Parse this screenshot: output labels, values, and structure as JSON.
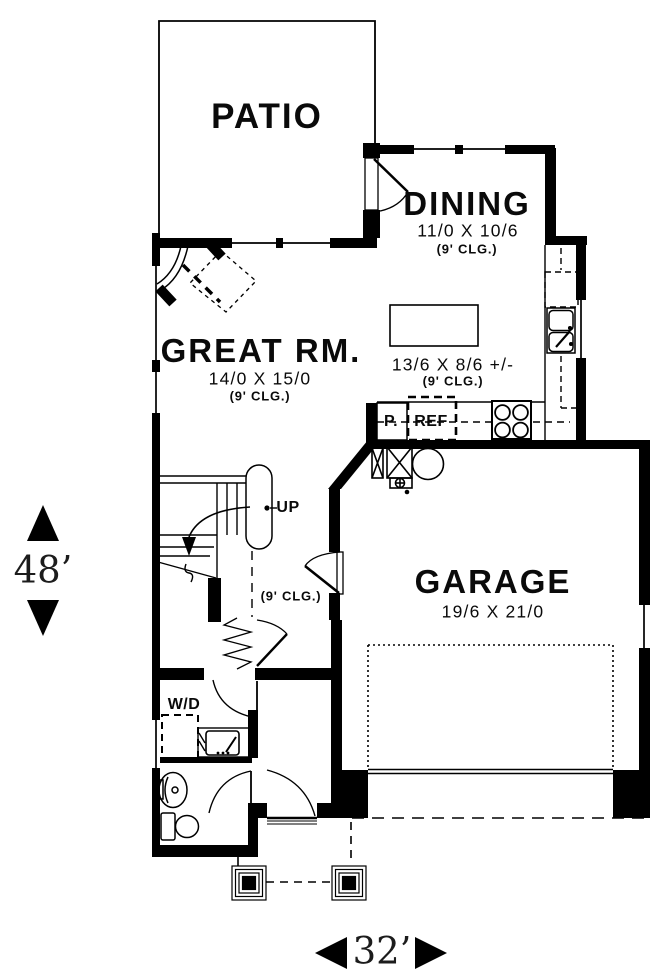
{
  "plan": {
    "patio": {
      "label": "PATIO"
    },
    "dining": {
      "label": "DINING",
      "dims": "11/0 X 10/6",
      "clg": "(9' CLG.)"
    },
    "great_room": {
      "label": "GREAT RM.",
      "dims": "14/0 X 15/0",
      "clg": "(9' CLG.)"
    },
    "kitchen": {
      "dims": "13/6 X 8/6 +/-",
      "clg": "(9' CLG.)"
    },
    "garage": {
      "label": "GARAGE",
      "dims": "19/6 X 21/0"
    },
    "hall": {
      "clg": "(9' CLG.)"
    },
    "laundry": {
      "label": "W/D"
    },
    "pantry": {
      "label": "P."
    },
    "refrigerator": {
      "label": "REF"
    },
    "stairs": {
      "label": "UP"
    },
    "dim_vertical": {
      "label": "48’"
    },
    "dim_horizontal": {
      "label": "32’"
    },
    "colors": {
      "ink": "#000000",
      "bg": "#ffffff"
    }
  }
}
